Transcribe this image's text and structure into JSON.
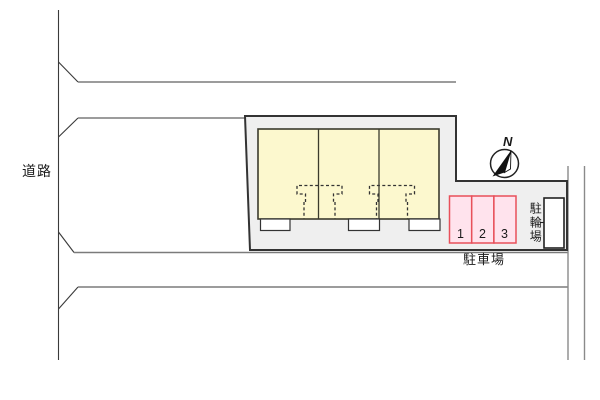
{
  "plan": {
    "road_label": "道路",
    "parking_label": "駐車場",
    "bicycle_parking_label": "駐輪場",
    "compass_north_label": "N",
    "parking_stalls": [
      "1",
      "2",
      "3"
    ],
    "building_unit_count": 3
  },
  "colors": {
    "building_fill": "#FCF8CE",
    "building_stroke": "#3B3B2D",
    "site_fill": "#EFEFEF",
    "site_stroke": "#333333",
    "parking_fill": "#FFE3ED",
    "parking_stroke": "#E8505A",
    "road_line": "#7B7B7B",
    "dark_line": "#3A3A3A"
  }
}
